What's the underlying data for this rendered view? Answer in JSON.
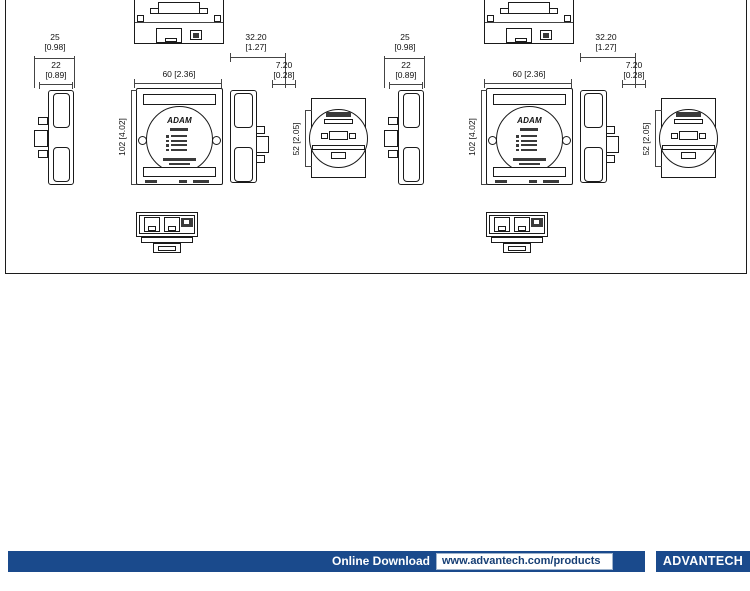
{
  "page": {
    "background": "#ffffff"
  },
  "drawing": {
    "line_color": "#1a1a1a",
    "front_logo": "ADAM",
    "dimensions": {
      "depth_total_mm": "25",
      "depth_total_in": "[0.98]",
      "depth_body_mm": "22",
      "depth_body_in": "[0.89]",
      "width_front": "60 [2.36]",
      "depth_side_mm": "32.20",
      "depth_side_in": "[1.27]",
      "clip_mm": "7.20",
      "clip_in": "[0.28]",
      "height_front": "102 [4.02]",
      "height_rear": "52 [2.05]"
    }
  },
  "footer": {
    "bar_color": "#1a4a8c",
    "download_label": "Online Download",
    "url": "www.advantech.com/products",
    "brand": "ADVANTECH"
  }
}
